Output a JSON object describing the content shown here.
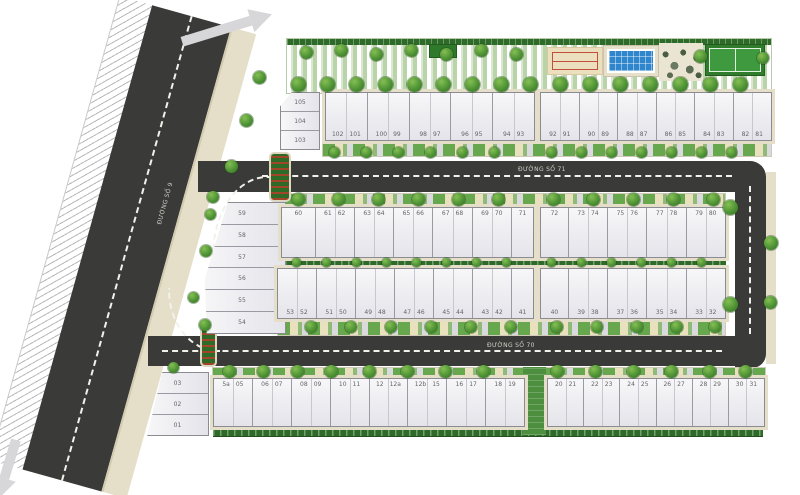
{
  "plan": {
    "title": "Residential lot master plan",
    "roads": {
      "road_70": "ĐƯỜNG SỐ 70",
      "road_71": "ĐƯỜNG SỐ 71",
      "road_9": "ĐƯỜNG SỐ 9"
    },
    "blocks": [
      {
        "id": "top-left-col",
        "lots": [
          "105",
          "104",
          "103"
        ]
      },
      {
        "id": "top-a",
        "lots": [
          "102 101",
          "100 99",
          "98 97",
          "96 95",
          "94 93"
        ]
      },
      {
        "id": "top-b",
        "lots": [
          "92 91",
          "90 89",
          "88 87",
          "86 85",
          "84 83",
          "82 81"
        ]
      },
      {
        "id": "mid-left-col",
        "lots": [
          "59",
          "58",
          "57",
          "56",
          "55",
          "54"
        ]
      },
      {
        "id": "mid-upper-a",
        "lots": [
          "60",
          "61 62",
          "63 64",
          "65 66",
          "67 68",
          "69 70",
          "71"
        ]
      },
      {
        "id": "mid-upper-b",
        "lots": [
          "72",
          "73 74",
          "75 76",
          "77 78",
          "79 80"
        ]
      },
      {
        "id": "mid-lower-a",
        "lots": [
          "53 52",
          "51 50",
          "49 48",
          "47 46",
          "45 44",
          "43 42",
          "41"
        ]
      },
      {
        "id": "mid-lower-b",
        "lots": [
          "40",
          "39 38",
          "37 36",
          "35 34",
          "33 32"
        ]
      },
      {
        "id": "bottom-left-col",
        "lots": [
          "03",
          "02",
          "01"
        ]
      },
      {
        "id": "bottom-a",
        "lots": [
          "5a 05",
          "06 07",
          "08 09",
          "10 11",
          "12 12a",
          "12b 15",
          "16 17",
          "18 19"
        ]
      },
      {
        "id": "bottom-b",
        "lots": [
          "20 21",
          "22 23",
          "24 25",
          "26 27",
          "28 29",
          "30 31"
        ]
      }
    ],
    "amenities": [
      {
        "id": "sport-court",
        "icon": "sport-court-icon"
      },
      {
        "id": "swimming-pool",
        "icon": "pool-icon"
      },
      {
        "id": "rock-garden",
        "icon": "rock-garden-icon"
      },
      {
        "id": "lawn-court",
        "icon": "lawn-court-icon"
      }
    ],
    "colors": {
      "asphalt": "#3a3a38",
      "sidewalk": "#e5dfc9",
      "grass": "#4f9335",
      "hedge": "#2e6b28",
      "pool": "#2f86cc",
      "roof": "#eeeef2",
      "sand_court": "#ecdfbe",
      "green_court": "#3f9a3f",
      "court_line_red": "#c0503c"
    }
  }
}
